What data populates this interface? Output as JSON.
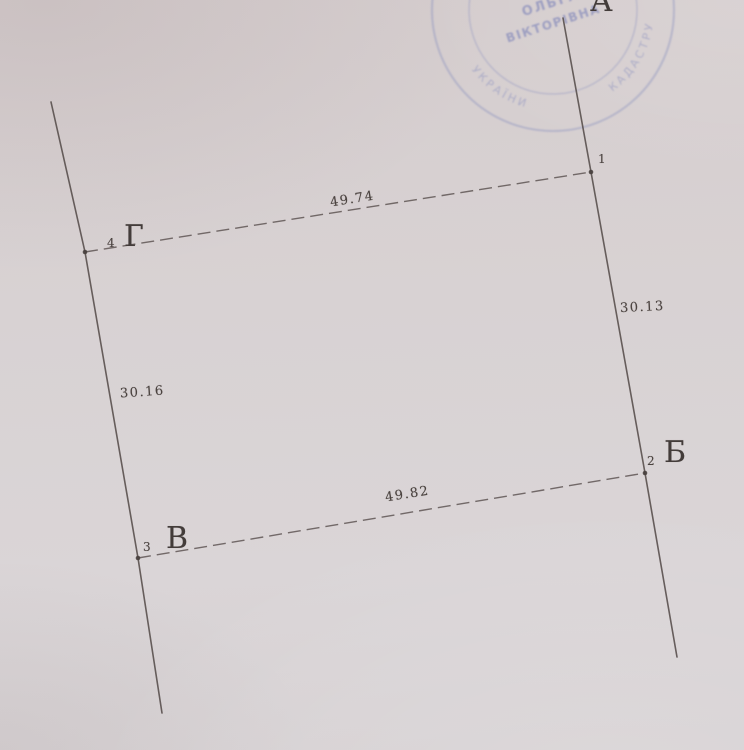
{
  "parcel": {
    "vertex_labels": [
      {
        "number": "1",
        "letter": "А"
      },
      {
        "number": "2",
        "letter": "Б"
      },
      {
        "number": "3",
        "letter": "В"
      },
      {
        "number": "4",
        "letter": "Г"
      }
    ],
    "side_lengths": {
      "top": "49.74",
      "right": "30.13",
      "bottom": "49.82",
      "left": "30.16"
    }
  },
  "stamp": {
    "center_line1": "ОЛЬГА",
    "center_line2": "ВІКТОРІВНА",
    "ring_left": "УКРАЇНИ",
    "ring_right": "КАДАСТРУ",
    "ink_color": "#8a90bf"
  },
  "colors": {
    "paper": "#d8d2d3",
    "ink": "#4b4340"
  }
}
